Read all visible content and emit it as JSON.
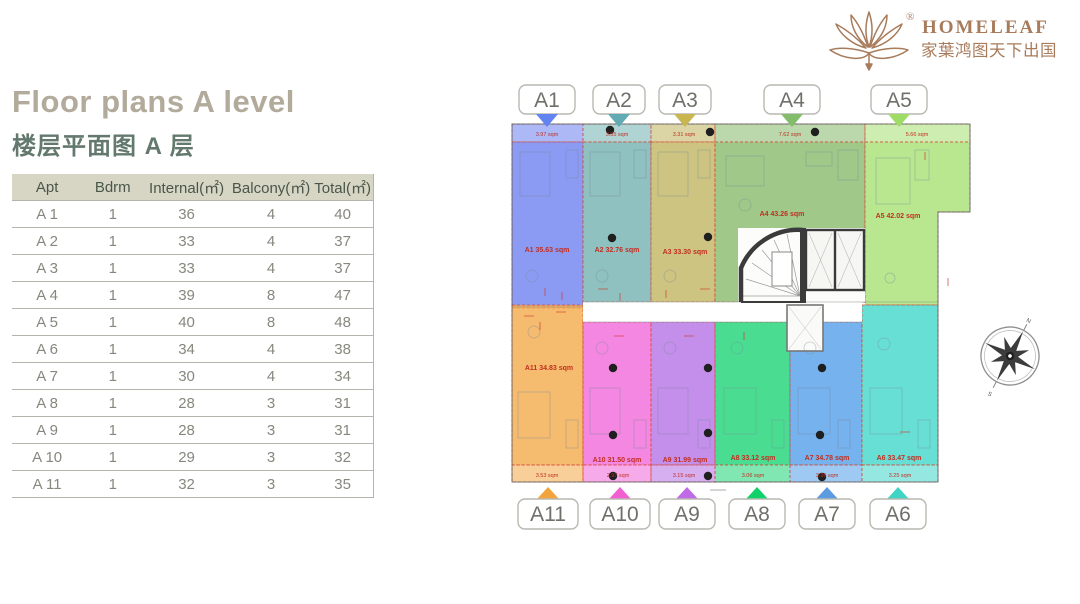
{
  "logo": {
    "registered": "®",
    "brand": "HOMELEAF",
    "chinese": "家葉鸿图天下出国",
    "color": "#a87b5b"
  },
  "header": {
    "title": "Floor plans A level",
    "subtitle": "楼层平面图 A 层",
    "title_color": "#b2aa9a",
    "subtitle_color": "#64796d"
  },
  "table": {
    "headers": [
      "Apt",
      "Bdrm",
      "Internal(㎡)",
      "Balcony(㎡)",
      "Total(㎡)"
    ],
    "rows": [
      {
        "apt": "A 1",
        "bdrm": "1",
        "internal": "36",
        "balcony": "4",
        "total": "40"
      },
      {
        "apt": "A 2",
        "bdrm": "1",
        "internal": "33",
        "balcony": "4",
        "total": "37"
      },
      {
        "apt": "A 3",
        "bdrm": "1",
        "internal": "33",
        "balcony": "4",
        "total": "37"
      },
      {
        "apt": "A 4",
        "bdrm": "1",
        "internal": "39",
        "balcony": "8",
        "total": "47"
      },
      {
        "apt": "A 5",
        "bdrm": "1",
        "internal": "40",
        "balcony": "8",
        "total": "48"
      },
      {
        "apt": "A 6",
        "bdrm": "1",
        "internal": "34",
        "balcony": "4",
        "total": "38"
      },
      {
        "apt": "A 7",
        "bdrm": "1",
        "internal": "30",
        "balcony": "4",
        "total": "34"
      },
      {
        "apt": "A 8",
        "bdrm": "1",
        "internal": "28",
        "balcony": "3",
        "total": "31"
      },
      {
        "apt": "A 9",
        "bdrm": "1",
        "internal": "28",
        "balcony": "3",
        "total": "31"
      },
      {
        "apt": "A 10",
        "bdrm": "1",
        "internal": "29",
        "balcony": "3",
        "total": "32"
      },
      {
        "apt": "A 11",
        "bdrm": "1",
        "internal": "32",
        "balcony": "3",
        "total": "35"
      }
    ]
  },
  "floorplan": {
    "units": {
      "a1": {
        "id": "A1",
        "color": "#6a7ef0",
        "arrow_color": "#6283f2",
        "area_label": "A1 35.63 sqm",
        "balcony_label": "3.97 sqm"
      },
      "a2": {
        "id": "A2",
        "color": "#6fb0ae",
        "arrow_color": "#62aab4",
        "area_label": "A2 32.76 sqm",
        "balcony_label": "3.55 sqm"
      },
      "a3": {
        "id": "A3",
        "color": "#beb35c",
        "arrow_color": "#c9b650",
        "area_label": "A3 33.30 sqm",
        "balcony_label": "3.31 sqm"
      },
      "a4": {
        "id": "A4",
        "color": "#84b868",
        "arrow_color": "#83bc6a",
        "area_label": "A4 43.26 sqm",
        "balcony_label": "7.62 sqm"
      },
      "a5": {
        "id": "A5",
        "color": "#a4e070",
        "arrow_color": "#9edc66",
        "area_label": "A5 42.02 sqm",
        "balcony_label": "5.66 sqm"
      },
      "a6": {
        "id": "A6",
        "color": "#3ed6c8",
        "arrow_color": "#3fd4c4",
        "area_label": "A6 33.47 sqm",
        "balcony_label": "3.25 sqm"
      },
      "a7": {
        "id": "A7",
        "color": "#4f9ce8",
        "arrow_color": "#5b9be0",
        "area_label": "A7 34.78 sqm",
        "balcony_label": "3.36 sqm"
      },
      "a8": {
        "id": "A8",
        "color": "#17d473",
        "arrow_color": "#11d26a",
        "area_label": "A8 33.12 sqm",
        "balcony_label": "3.06 sqm"
      },
      "a9": {
        "id": "A9",
        "color": "#b46ee6",
        "arrow_color": "#c06ae8",
        "area_label": "A9 31.99 sqm",
        "balcony_label": "3.15 sqm"
      },
      "a10": {
        "id": "A10",
        "color": "#f065d8",
        "arrow_color": "#f25fd0",
        "area_label": "A10 31.50 sqm",
        "balcony_label": "2.97 sqm"
      },
      "a11": {
        "id": "A11",
        "color": "#f2a845",
        "arrow_color": "#f2a33c",
        "area_label": "A11 34.83 sqm",
        "balcony_label": "3.53 sqm"
      }
    },
    "compass": {
      "north": "N",
      "south": "S"
    }
  }
}
